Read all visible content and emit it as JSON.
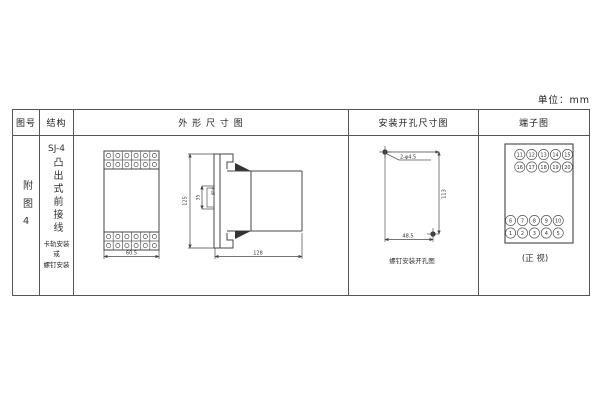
{
  "unit_label": "单位：mm",
  "table": {
    "headers": {
      "fig_no": "图号",
      "structure": "结构",
      "outline": "外 形 尺 寸 图",
      "install": "安装开孔尺寸图",
      "terminal": "端子图"
    }
  },
  "fig_no": {
    "value": "附图4"
  },
  "structure": {
    "model": "SJ-4",
    "type_vertical": "凸出式前接线",
    "mount_lines": [
      "卡轨安装",
      "或",
      "螺钉安装"
    ]
  },
  "outline": {
    "front_width": "60.5",
    "height": "125",
    "rail_width": "35",
    "rail_label": "卡轨",
    "depth": "128"
  },
  "install": {
    "holes_label": "2-φ4.5",
    "height": "113",
    "width": "48.5",
    "caption": "螺钉安装开孔图"
  },
  "terminals": {
    "top_rows": [
      [
        "11",
        "12",
        "13",
        "14",
        "15"
      ],
      [
        "16",
        "17",
        "18",
        "19",
        "20"
      ]
    ],
    "bottom_rows": [
      [
        "6",
        "7",
        "8",
        "9",
        "10"
      ],
      [
        "1",
        "2",
        "3",
        "4",
        "5"
      ]
    ],
    "caption": "(正 视)"
  }
}
